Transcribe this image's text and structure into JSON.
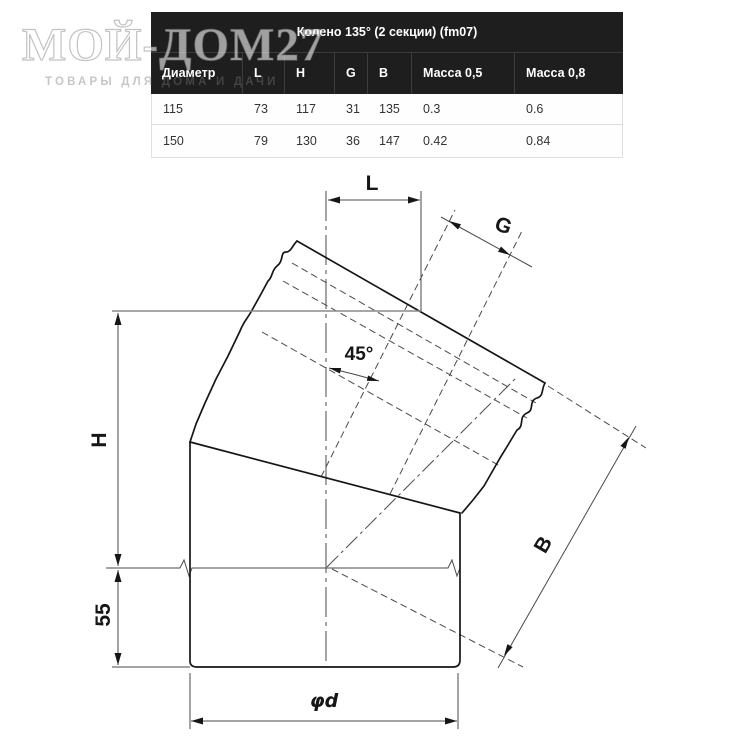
{
  "logo": {
    "title": "МОЙ-ДОМ27",
    "subtitle": "ТОВАРЫ ДЛЯ ДОМА И ДАЧИ"
  },
  "table": {
    "title": "Колено 135° (2 секции) (fm07)",
    "columns": [
      "Диаметр",
      "L",
      "H",
      "G",
      "B",
      "Масса 0,5",
      "Масса 0,8"
    ],
    "rows": [
      [
        "115",
        "73",
        "117",
        "31",
        "135",
        "0.3",
        "0.6"
      ],
      [
        "150",
        "79",
        "130",
        "36",
        "147",
        "0.42",
        "0.84"
      ]
    ]
  },
  "drawing": {
    "labels": {
      "width_top": "L",
      "seam": "G",
      "angle": "45°",
      "height": "H",
      "bottom_offset": "55",
      "section_length": "B",
      "diameter": "φd"
    }
  },
  "colors": {
    "table_header_bg": "#1e1e1e",
    "table_header_text": "#ffffff",
    "table_body_text": "#333333",
    "table_border": "#dcdcdc",
    "drawing_line": "#161616",
    "dimension_line": "#4a4a4a",
    "watermark": "#d9d9d9"
  }
}
